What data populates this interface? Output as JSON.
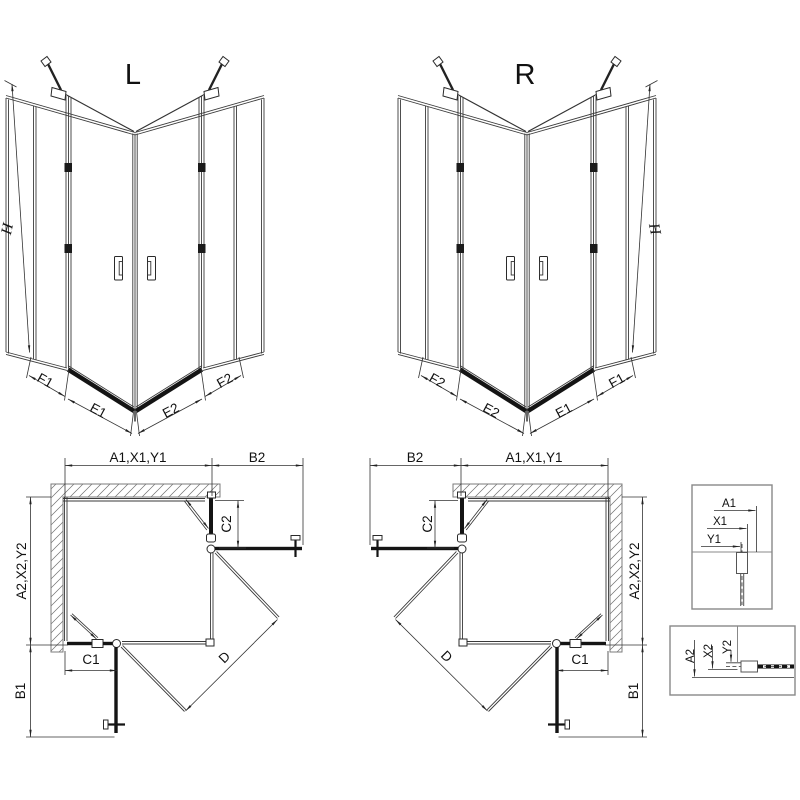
{
  "views": {
    "iso_left": {
      "label": "L",
      "height": "H",
      "segments": [
        "F1",
        "E1",
        "E2",
        "F2"
      ]
    },
    "iso_right": {
      "label": "R",
      "height": "H",
      "segments": [
        "F2",
        "E2",
        "E1",
        "F1"
      ]
    },
    "plan_left": {
      "width_top": "A1,X1,Y1",
      "outer_top": "B2",
      "depth": "A2,X2,Y2",
      "outer_bottom": "B1",
      "fixed_top": "C2",
      "fixed_bottom": "C1",
      "diagonal": "D"
    },
    "plan_right": {
      "width_top": "A1,X1,Y1",
      "outer_top": "B2",
      "depth": "A2,X2,Y2",
      "outer_bottom": "B1",
      "fixed_top": "C2",
      "fixed_bottom": "C1",
      "diagonal": "D"
    },
    "detail_wall": {
      "dims": [
        "A1",
        "X1",
        "Y1"
      ]
    },
    "detail_floor": {
      "dims": [
        "A2",
        "X2",
        "Y2"
      ]
    }
  },
  "colors": {
    "line": "#333333",
    "dark": "#141414",
    "wall_outline": "#7b7b7b",
    "background": "#ffffff"
  }
}
